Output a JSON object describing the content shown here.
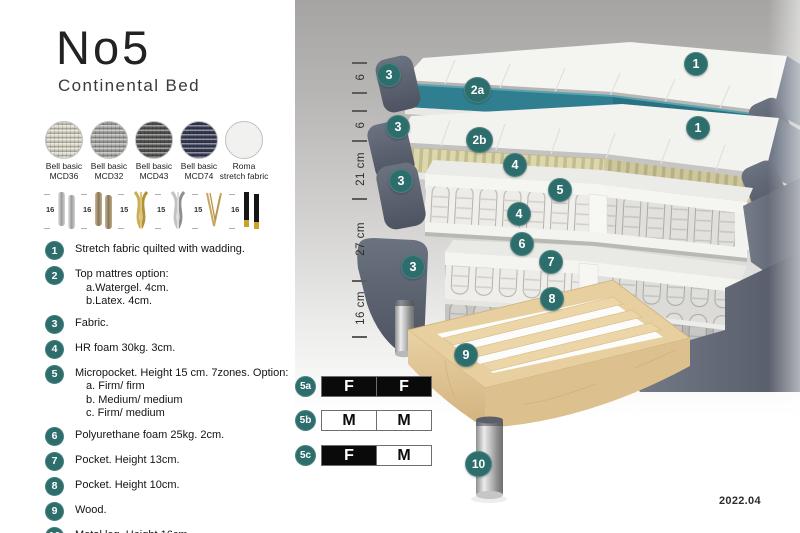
{
  "header": {
    "title": "No5",
    "subtitle": "Continental Bed"
  },
  "fabrics": {
    "items": [
      {
        "line1": "Bell basic",
        "line2": "MCD36",
        "color": "#d7d3c6",
        "textured": true
      },
      {
        "line1": "Bell basic",
        "line2": "MCD32",
        "color": "#a6a6a4",
        "textured": true
      },
      {
        "line1": "Bell basic",
        "line2": "MCD43",
        "color": "#565855",
        "textured": true
      },
      {
        "line1": "Bell basic",
        "line2": "MCD74",
        "color": "#383d56",
        "textured": true
      },
      {
        "line1": "Roma",
        "line2": "stretch fabric",
        "color": "#f1f1f0",
        "textured": false
      }
    ]
  },
  "legs": {
    "items": [
      {
        "size": "16",
        "type": "cylinder-silver"
      },
      {
        "size": "16",
        "type": "cylinder-bronze"
      },
      {
        "size": "15",
        "type": "twist-gold"
      },
      {
        "size": "15",
        "type": "twist-silver"
      },
      {
        "size": "15",
        "type": "hairpin-gold"
      },
      {
        "size": "16",
        "type": "straight-black-gold"
      }
    ]
  },
  "spec_list": {
    "items": [
      {
        "num": "1",
        "text": "Stretch fabric quilted with wadding.",
        "sub": []
      },
      {
        "num": "2",
        "text": "Top mattres option:",
        "sub": [
          "a.Watergel. 4cm.",
          "b.Latex. 4cm."
        ]
      },
      {
        "num": "3",
        "text": "Fabric.",
        "sub": []
      },
      {
        "num": "4",
        "text": "HR foam 30kg. 3cm.",
        "sub": []
      },
      {
        "num": "5",
        "text": "Micropocket. Height 15 cm. 7zones. Option:",
        "sub": [
          "a. Firm/ firm",
          "b. Medium/ medium",
          "c. Firm/ medium"
        ]
      },
      {
        "num": "6",
        "text": "Polyurethane foam 25kg. 2cm.",
        "sub": []
      },
      {
        "num": "7",
        "text": "Pocket. Height 13cm.",
        "sub": []
      },
      {
        "num": "8",
        "text": "Pocket. Height 10cm.",
        "sub": []
      },
      {
        "num": "9",
        "text": "Wood.",
        "sub": []
      },
      {
        "num": "10",
        "text": "Metal leg. Height 16cm.",
        "sub": []
      }
    ]
  },
  "illustration": {
    "callouts": [
      "3",
      "2a",
      "1",
      "3",
      "2b",
      "1",
      "4",
      "5",
      "4",
      "3",
      "6",
      "7",
      "3",
      "8",
      "9",
      "10"
    ],
    "dimensions": {
      "labels": [
        "6",
        "6",
        "21 cm",
        "27 cm",
        "16 cm"
      ]
    },
    "firmness_table": {
      "rows": [
        {
          "id": "5a",
          "cells": [
            "F",
            "F"
          ]
        },
        {
          "id": "5b",
          "cells": [
            "M",
            "M"
          ]
        },
        {
          "id": "5c",
          "cells": [
            "F",
            "M"
          ]
        }
      ]
    },
    "version": "2022.04",
    "colors": {
      "badge_teal": "#2d6e6d",
      "topper_core_teal": "#2f7f90",
      "latex_core": "#ddd7ae",
      "fabric_slate": "#596070",
      "wood": "#e7cf9f"
    }
  }
}
